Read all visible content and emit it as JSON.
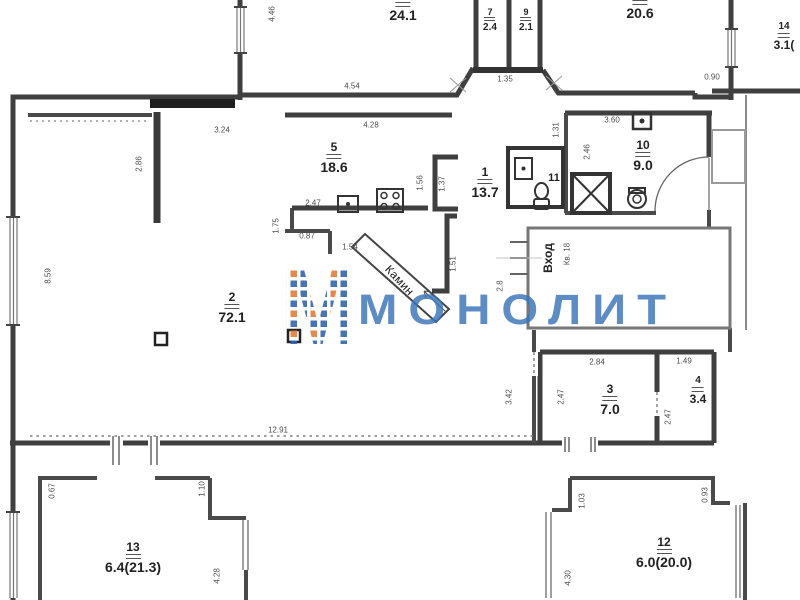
{
  "plan": {
    "rooms": [
      {
        "number": "",
        "area": "24.1"
      },
      {
        "number": "",
        "area": "20.6"
      },
      {
        "number": "7",
        "area": "2.4"
      },
      {
        "number": "9",
        "area": "2.1"
      },
      {
        "number": "14",
        "area": "3.1("
      },
      {
        "number": "5",
        "area": "18.6"
      },
      {
        "number": "1",
        "area": "13.7"
      },
      {
        "number": "10",
        "area": "9.0"
      },
      {
        "number": "2",
        "area": "72.1"
      },
      {
        "number": "3",
        "area": "7.0"
      },
      {
        "number": "4",
        "area": "3.4"
      },
      {
        "number": "13",
        "area": "6.4(21.3)"
      },
      {
        "number": "12",
        "area": "6.0(20.0)"
      }
    ],
    "room_plain": {
      "number": "11"
    },
    "annotations": {
      "fireplace": "Камин",
      "entrance": "Вход",
      "apartment_no": "Кв. 18"
    },
    "dims": [
      {
        "t": "4.46"
      },
      {
        "t": "4.54"
      },
      {
        "t": "1.35"
      },
      {
        "t": "0.90"
      },
      {
        "t": "3.24"
      },
      {
        "t": "4.28"
      },
      {
        "t": "3.60"
      },
      {
        "t": "1.31"
      },
      {
        "t": "2.46"
      },
      {
        "t": "1.56"
      },
      {
        "t": "1.37"
      },
      {
        "t": "2.47"
      },
      {
        "t": "1.75"
      },
      {
        "t": "0.87"
      },
      {
        "t": "1.54"
      },
      {
        "t": "1.51"
      },
      {
        "t": "2.8"
      },
      {
        "t": "2.86"
      },
      {
        "t": "8.59"
      },
      {
        "t": "12.91"
      },
      {
        "t": "2.84"
      },
      {
        "t": "1.49"
      },
      {
        "t": "3.42"
      },
      {
        "t": "2.47"
      },
      {
        "t": "2.47"
      },
      {
        "t": "0.67"
      },
      {
        "t": "1.10"
      },
      {
        "t": "4.28"
      },
      {
        "t": "1.03"
      },
      {
        "t": "0.93"
      },
      {
        "t": "4.30"
      }
    ]
  },
  "watermark": {
    "logo_letter": "М",
    "text": "МОНОЛИТ",
    "brand_blue": "#2f63a8",
    "accent_orange": "#e07b39"
  }
}
